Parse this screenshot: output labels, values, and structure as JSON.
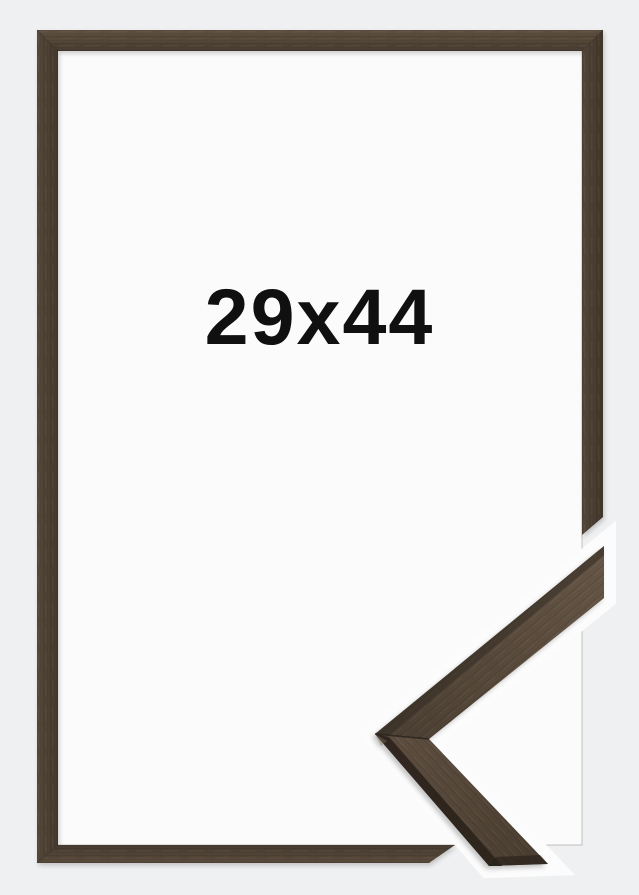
{
  "product_preview": {
    "size_label": "29x44",
    "description": "brown wood picture frame with mitered corner profile sample",
    "colors": {
      "backdrop": "#eff0f1",
      "interior": "#fbfbfb",
      "wood_base": "#504436",
      "wood_dark": "#2e2720",
      "wood_light": "#6e5d4b",
      "sticker_white": "#fcfcfc",
      "label_text": "#101010"
    }
  }
}
